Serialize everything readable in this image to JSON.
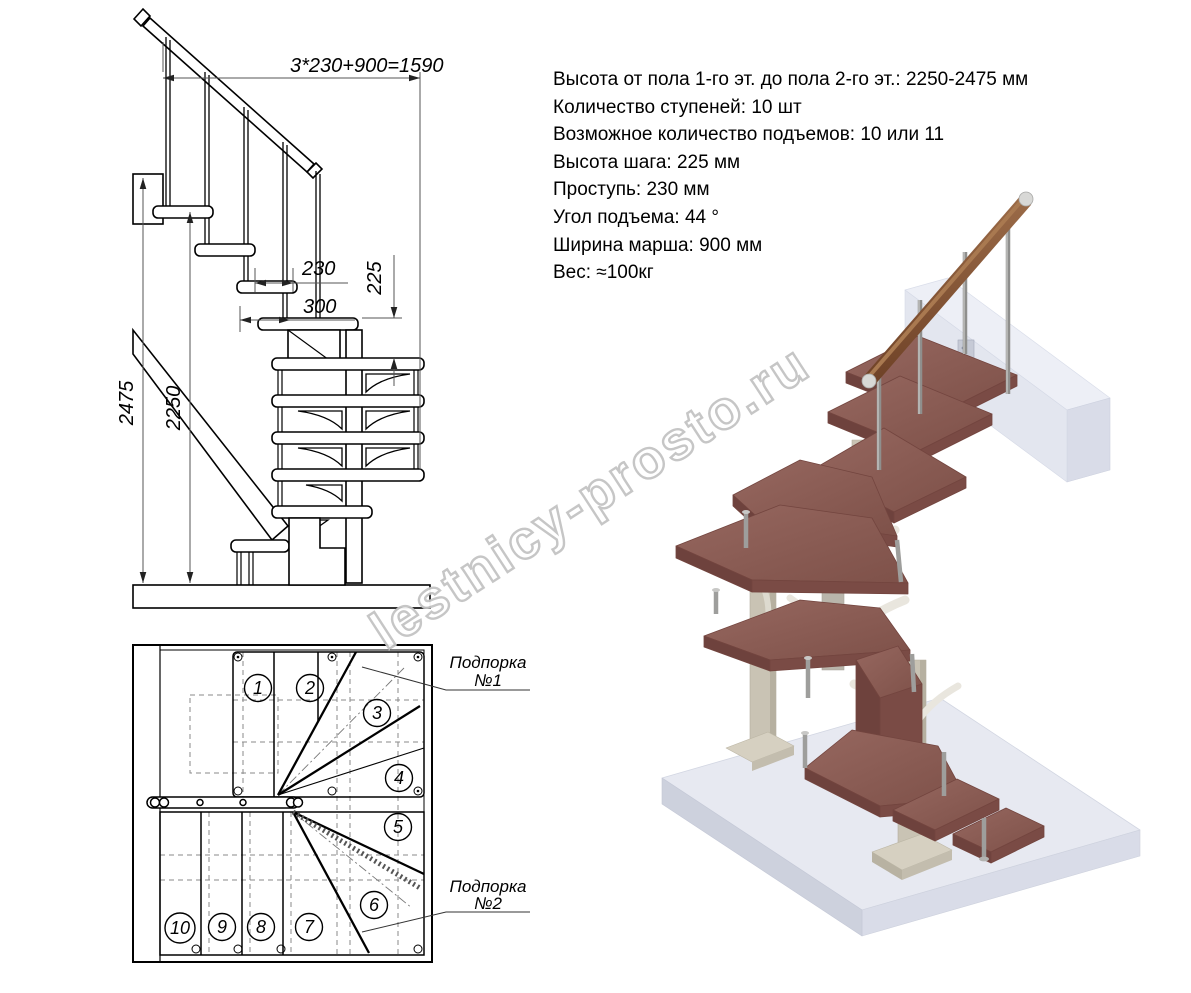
{
  "watermark": {
    "text": "lestnicy-prosto.ru",
    "color": "#c3c3c3"
  },
  "specs": {
    "lines": [
      "Высота от пола 1-го эт. до пола 2-го эт.: 2250-2475 мм",
      "Количество ступеней: 10 шт",
      "Возможное количество подъемов: 10 или 11",
      "Высота шага: 225 мм",
      "Проступь: 230 мм",
      "Угол подъема: 44 °",
      "Ширина марша: 900 мм",
      "Вес: ≈100кг"
    ]
  },
  "elevation": {
    "dim_total": "3*230+900=1590",
    "dim_tread": "230",
    "dim_landing": "300",
    "dim_rise": "225",
    "dim_full_height": "2475",
    "dim_floor_height": "2250"
  },
  "plan": {
    "steps": [
      "1",
      "2",
      "3",
      "4",
      "5",
      "6",
      "7",
      "8",
      "9",
      "10"
    ],
    "support1": {
      "line1": "Подпорка",
      "line2": "№1"
    },
    "support2": {
      "line1": "Подпорка",
      "line2": "№2"
    }
  },
  "colors": {
    "tread_wood": "#8d6059",
    "tread_edge": "#6e423d",
    "handrail_wood": "#7c4d33",
    "metal_baluster": "#9e9e9c",
    "support_column": "#c9c3b4",
    "bracket_white": "#e9e6de",
    "floor_slab": "#e7e9f1",
    "drawing_line": "#000000"
  }
}
